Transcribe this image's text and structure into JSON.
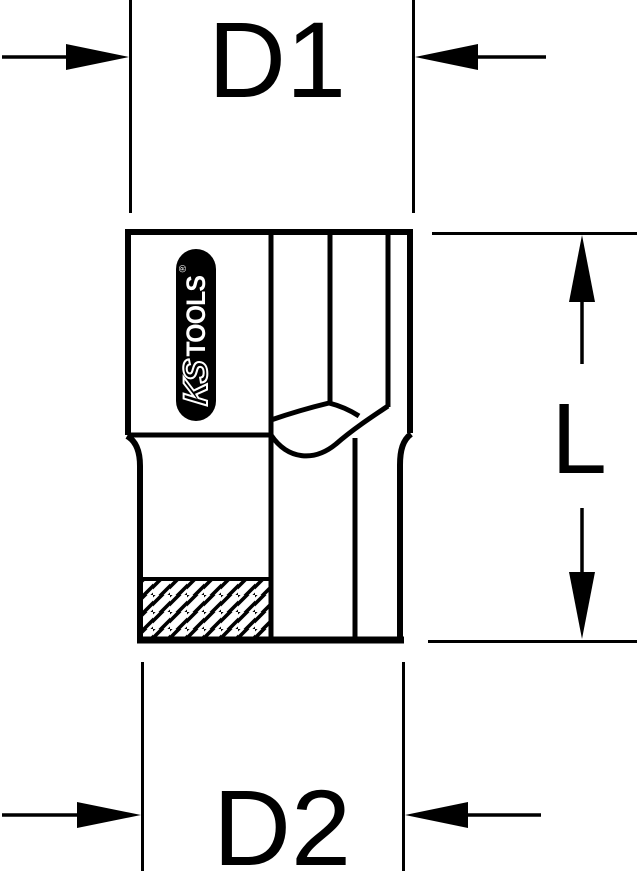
{
  "diagram": {
    "type": "technical-drawing-socket",
    "labels": {
      "d1": "D1",
      "d2": "D2",
      "length": "L"
    },
    "logo": {
      "ks": "KS",
      "tools": "TOOLS",
      "registered": "®"
    },
    "colors": {
      "line": "#000000",
      "background": "#ffffff"
    }
  }
}
